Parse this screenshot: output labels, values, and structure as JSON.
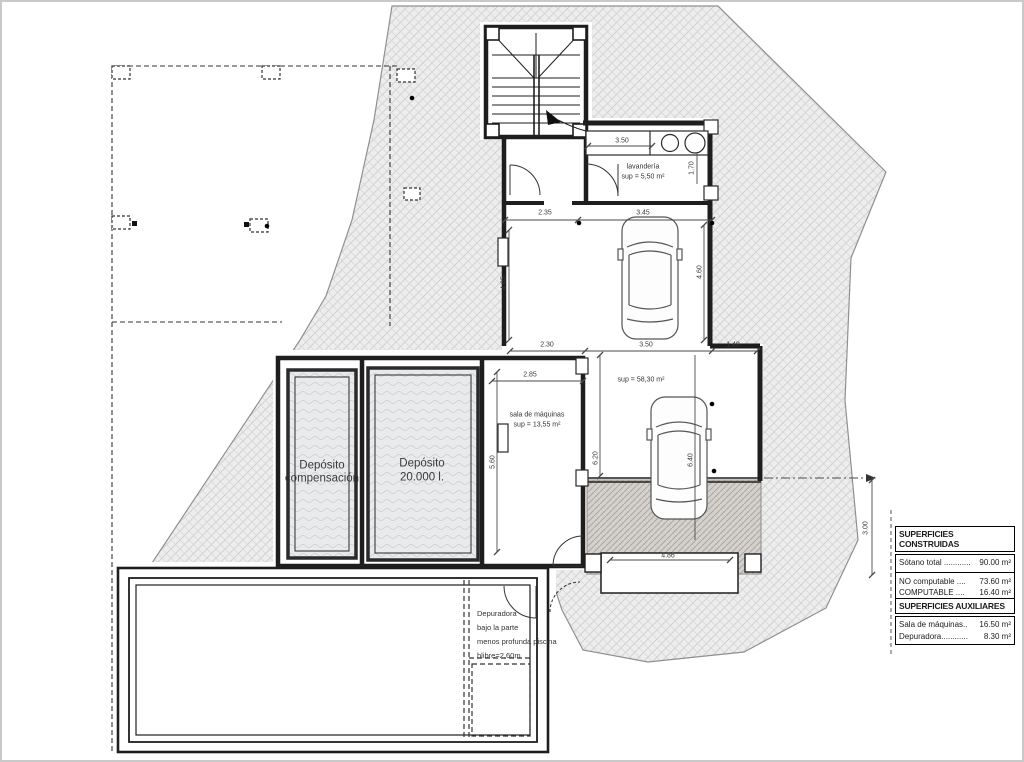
{
  "labels": {
    "deposito_compensacion": {
      "line1": "Depósito",
      "line2": "compensación"
    },
    "deposito_20000": {
      "line1": "Depósito",
      "line2": "20.000 l."
    },
    "sala_maquinas": {
      "name": "sala de máquinas",
      "area": "sup = 13,55 m²"
    },
    "lavanderia": {
      "name": "lavandería",
      "area": "sup = 5,50 m²"
    },
    "garaje_area": "sup = 58,30 m²",
    "depuradora_note": {
      "line1": "Depuradora",
      "line2": "bajo la parte",
      "line3": "menos profunda piscina",
      "line4": "hlibre=2,60m"
    }
  },
  "dimensions": {
    "top_left": "2.35",
    "top_right": "3.45",
    "mid_left": "2.30",
    "mid_center": "3.50",
    "mid_right": "1.40",
    "sala_width": "2.85",
    "lavanderia_width": "3.50",
    "lavanderia_height": "1.70",
    "garage_left_height": "4.65",
    "garage_right_height": "4.60",
    "sala_height": "5.60",
    "lower_left_height": "6.20",
    "lower_right_height": "6.40",
    "drain_width": "4.86",
    "ramp_height": "3.00"
  },
  "legend": {
    "construidas": {
      "title": "SUPERFICIES CONSTRUIDAS",
      "rows": [
        {
          "label": "Sótano total ............",
          "value": "90.00 m²"
        },
        {
          "label": "NO computable ....",
          "value": "73.60 m²"
        },
        {
          "label": "COMPUTABLE    ....",
          "value": "16.40 m²"
        }
      ]
    },
    "auxiliares": {
      "title": "SUPERFICIES AUXILIARES",
      "rows": [
        {
          "label": "Sala de máquinas..",
          "value": "16.50 m²"
        },
        {
          "label": "Depuradora............",
          "value": "8.30 m²"
        }
      ]
    }
  }
}
